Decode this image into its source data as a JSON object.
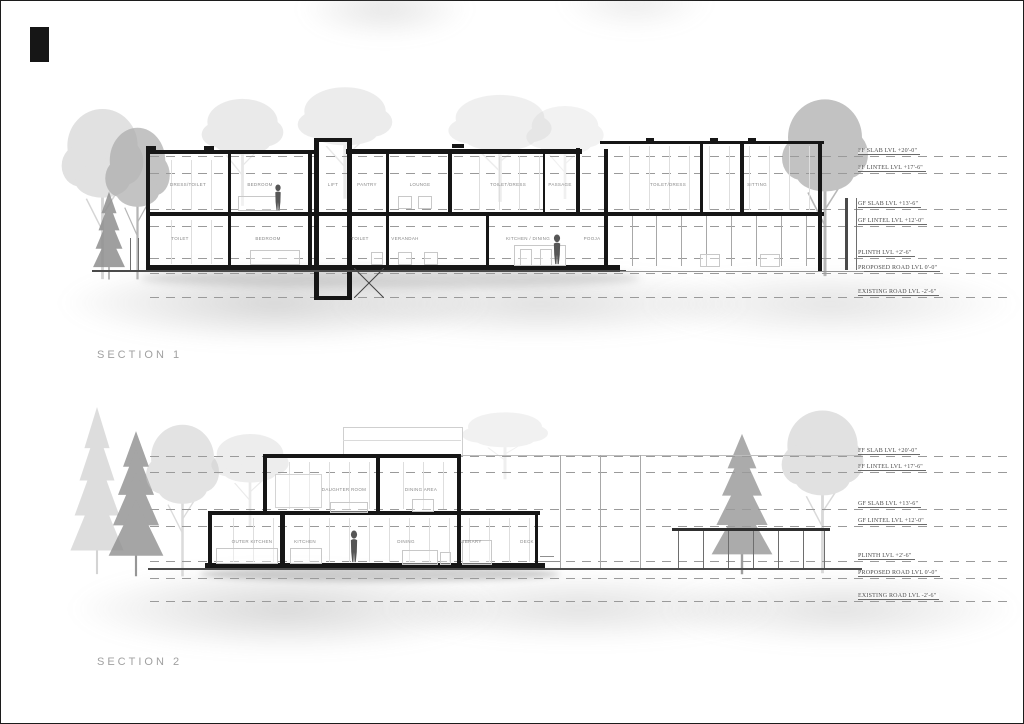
{
  "sheet": {
    "type": "architectural-sections-sheet",
    "colors": {
      "wall_cut": "#161616",
      "ground": "#4a4a4a",
      "room_label": "#898989",
      "level_text": "#4a4a4a",
      "tree_light": "#c9c9c9",
      "tree_dark": "#8f8f8f",
      "background": "#ffffff"
    }
  },
  "s1": {
    "title": "SECTION 1",
    "rooms_upper": [
      "DRESS/TOILET",
      "BEDROOM",
      "LIFT",
      "PANTRY",
      "LOUNGE",
      "TOILET/DRESS",
      "PASSAGE",
      "TOILET/DRESS",
      "SITTING"
    ],
    "rooms_lower": [
      "TOILET",
      "BEDROOM",
      "TOILET",
      "VERANDAH",
      "KITCHEN / DINING",
      "POOJA"
    ],
    "levels": [
      "FF SLAB LVL  +20'-0\"",
      "FF LINTEL LVL  +17'-6\"",
      "GF SLAB LVL  +13'-6\"",
      "GF LINTEL LVL  +12'-0\"",
      "PLINTH LVL  +2'-6\"",
      "PROPOSED ROAD LVL  0'-0\"",
      "EXISTING ROAD LVL  -2'-6\""
    ]
  },
  "s2": {
    "title": "SECTION 2",
    "rooms_upper": [
      "DAUGHTER ROOM",
      "DINING AREA"
    ],
    "rooms_lower": [
      "OUTER KITCHEN",
      "KITCHEN",
      "DINING",
      "LIBRARY",
      "DECK"
    ],
    "levels": [
      "FF SLAB LVL  +20'-0\"",
      "FF LINTEL LVL  +17'-6\"",
      "GF SLAB LVL  +13'-6\"",
      "GF LINTEL LVL  +12'-0\"",
      "PLINTH LVL  +2'-6\"",
      "PROPOSED ROAD LVL  0'-0\"",
      "EXISTING ROAD LVL  -2'-6\""
    ]
  }
}
